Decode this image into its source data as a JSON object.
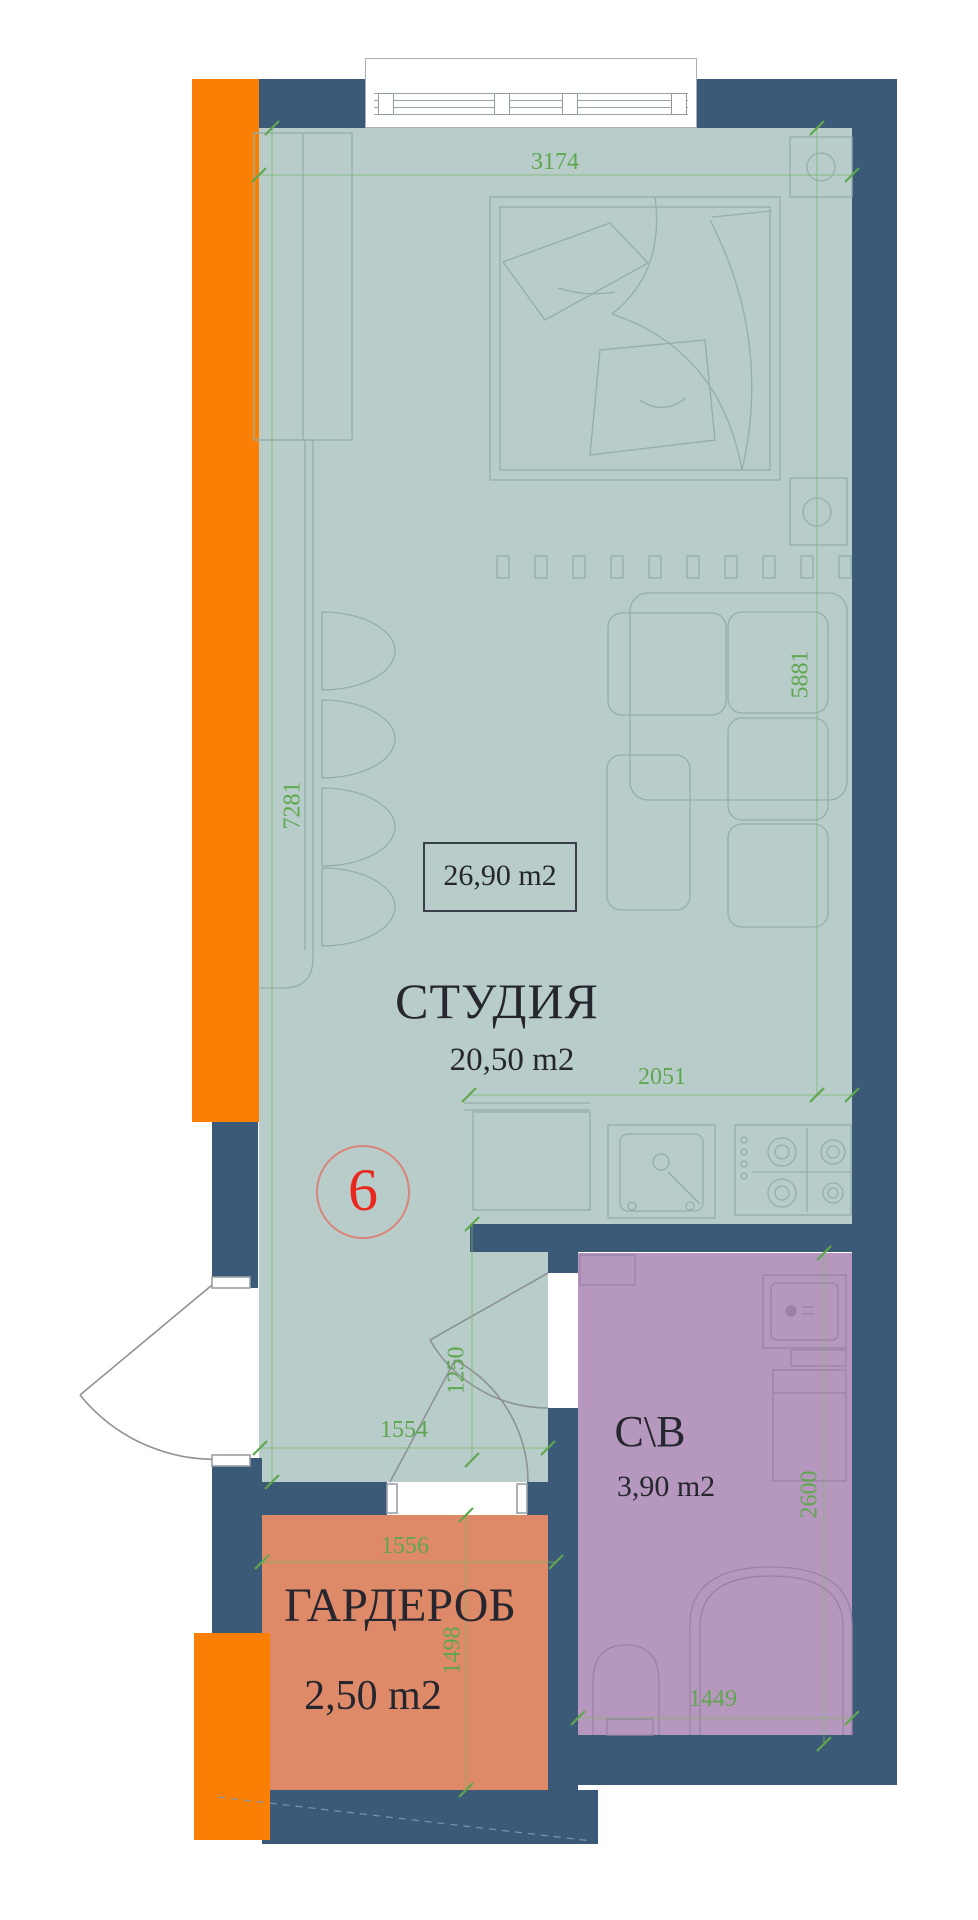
{
  "unit": {
    "number": "6"
  },
  "total_area_label": "26,90 m2",
  "rooms": {
    "studio": {
      "name": "СТУДИЯ",
      "area": "20,50 m2"
    },
    "wardrobe": {
      "name": "ГАРДЕРОБ",
      "area": "2,50 m2"
    },
    "bathroom": {
      "name": "С\\В",
      "area": "3,90 m2"
    }
  },
  "dimensions_mm": {
    "studio_width_top": "3174",
    "studio_height_right": "5881",
    "studio_height_left": "7281",
    "kitchen_width": "2051",
    "entry_zone_height": "1250",
    "entry_zone_width": "1554",
    "wardrobe_width": "1556",
    "wardrobe_height": "1498",
    "bathroom_height": "2600",
    "bathroom_width": "1449"
  },
  "colors": {
    "wall_navy": "#3b5a78",
    "floor_teal": "#b8cdc9",
    "bathroom_purple": "#b697bd",
    "wardrobe_salmon": "#de8a69",
    "facade_orange": "#fa8005",
    "dimension_green": "#5fa74e",
    "unit_red": "#e8281e",
    "furniture_line": "#93aeac"
  }
}
